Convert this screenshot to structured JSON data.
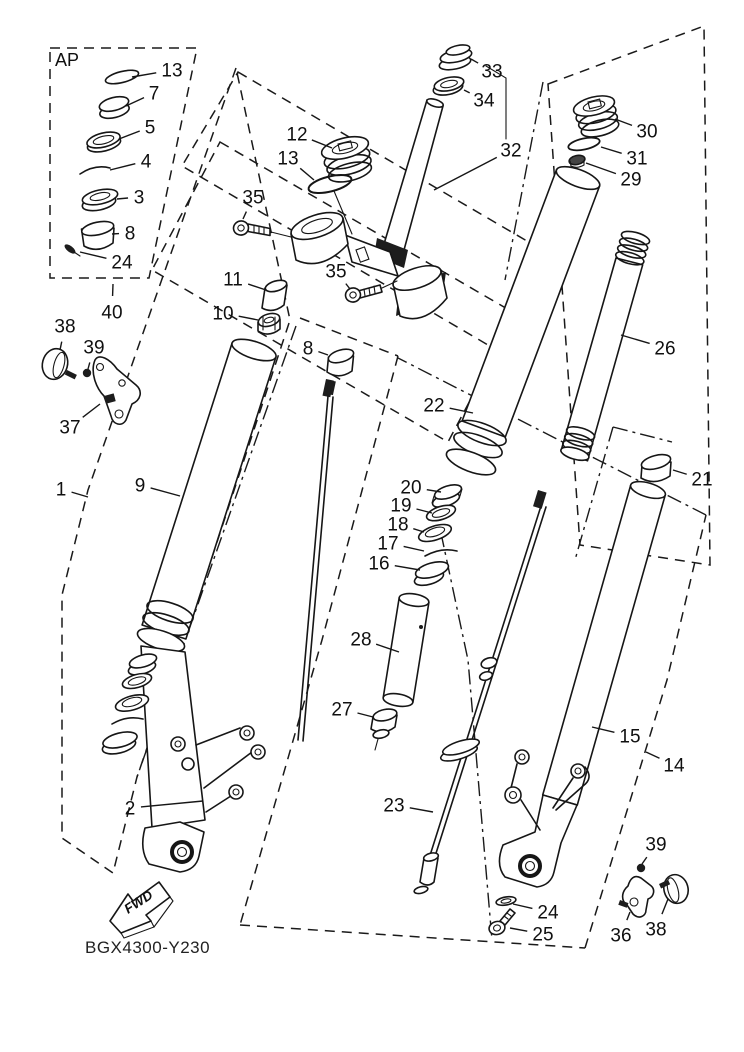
{
  "diagram": {
    "ap_label": "AP",
    "code": "BGX4300-Y230",
    "fwd_label": "FWD",
    "callouts": [
      {
        "n": "13",
        "x": 172,
        "y": 70,
        "px": 132,
        "py": 77
      },
      {
        "n": "7",
        "x": 154,
        "y": 93,
        "px": 126,
        "py": 106
      },
      {
        "n": "5",
        "x": 150,
        "y": 127,
        "px": 119,
        "py": 139
      },
      {
        "n": "4",
        "x": 146,
        "y": 161,
        "px": 110,
        "py": 170
      },
      {
        "n": "3",
        "x": 139,
        "y": 197,
        "px": 117,
        "py": 199
      },
      {
        "n": "8",
        "x": 130,
        "y": 233,
        "px": 112,
        "py": 234
      },
      {
        "n": "24",
        "x": 122,
        "y": 262,
        "px": 80,
        "py": 252
      },
      {
        "n": "40",
        "x": 112,
        "y": 312,
        "px": 113,
        "py": 284
      },
      {
        "n": "38",
        "x": 65,
        "y": 326,
        "px": 60,
        "py": 350
      },
      {
        "n": "39",
        "x": 94,
        "y": 347,
        "px": 88,
        "py": 369
      },
      {
        "n": "37",
        "x": 70,
        "y": 427,
        "px": 100,
        "py": 404
      },
      {
        "n": "1",
        "x": 61,
        "y": 489,
        "px": 88,
        "py": 497
      },
      {
        "n": "9",
        "x": 140,
        "y": 485,
        "px": 180,
        "py": 496
      },
      {
        "n": "12",
        "x": 297,
        "y": 134,
        "px": 332,
        "py": 148
      },
      {
        "n": "13",
        "x": 288,
        "y": 158,
        "px": 314,
        "py": 180
      },
      {
        "n": "35",
        "x": 253,
        "y": 197,
        "px": 243,
        "py": 219
      },
      {
        "n": "35",
        "x": 336,
        "y": 271,
        "px": 350,
        "py": 289
      },
      {
        "n": "11",
        "x": 233,
        "y": 279,
        "px": 266,
        "py": 290
      },
      {
        "n": "10",
        "x": 223,
        "y": 313,
        "px": 258,
        "py": 320
      },
      {
        "n": "8",
        "x": 308,
        "y": 348,
        "px": 328,
        "py": 355
      },
      {
        "n": "33",
        "x": 492,
        "y": 71,
        "px": 471,
        "py": 59
      },
      {
        "n": "34",
        "x": 484,
        "y": 100,
        "px": 464,
        "py": 90
      },
      {
        "n": "32",
        "x": 511,
        "y": 150,
        "px": 434,
        "py": 190
      },
      {
        "n": "30",
        "x": 647,
        "y": 131,
        "px": 615,
        "py": 119
      },
      {
        "n": "31",
        "x": 637,
        "y": 158,
        "px": 601,
        "py": 147
      },
      {
        "n": "29",
        "x": 631,
        "y": 179,
        "px": 586,
        "py": 163
      },
      {
        "n": "26",
        "x": 665,
        "y": 348,
        "px": 621,
        "py": 335
      },
      {
        "n": "22",
        "x": 434,
        "y": 405,
        "px": 473,
        "py": 413
      },
      {
        "n": "20",
        "x": 411,
        "y": 487,
        "px": 441,
        "py": 492
      },
      {
        "n": "19",
        "x": 401,
        "y": 505,
        "px": 432,
        "py": 513
      },
      {
        "n": "18",
        "x": 398,
        "y": 524,
        "px": 424,
        "py": 532
      },
      {
        "n": "17",
        "x": 388,
        "y": 543,
        "px": 424,
        "py": 551
      },
      {
        "n": "16",
        "x": 379,
        "y": 563,
        "px": 420,
        "py": 570
      },
      {
        "n": "21",
        "x": 702,
        "y": 479,
        "px": 673,
        "py": 470
      },
      {
        "n": "28",
        "x": 361,
        "y": 639,
        "px": 399,
        "py": 652
      },
      {
        "n": "27",
        "x": 342,
        "y": 709,
        "px": 373,
        "py": 717
      },
      {
        "n": "15",
        "x": 630,
        "y": 736,
        "px": 592,
        "py": 727
      },
      {
        "n": "14",
        "x": 674,
        "y": 765,
        "px": 646,
        "py": 752
      },
      {
        "n": "23",
        "x": 394,
        "y": 805,
        "px": 433,
        "py": 812
      },
      {
        "n": "2",
        "x": 130,
        "y": 808,
        "px": 203,
        "py": 801
      },
      {
        "n": "24",
        "x": 548,
        "y": 912,
        "px": 513,
        "py": 904
      },
      {
        "n": "25",
        "x": 543,
        "y": 934,
        "px": 510,
        "py": 928
      },
      {
        "n": "39",
        "x": 656,
        "y": 844,
        "px": 642,
        "py": 864
      },
      {
        "n": "36",
        "x": 621,
        "y": 935,
        "px": 630,
        "py": 912
      },
      {
        "n": "38",
        "x": 656,
        "y": 929,
        "px": 668,
        "py": 899
      }
    ]
  }
}
